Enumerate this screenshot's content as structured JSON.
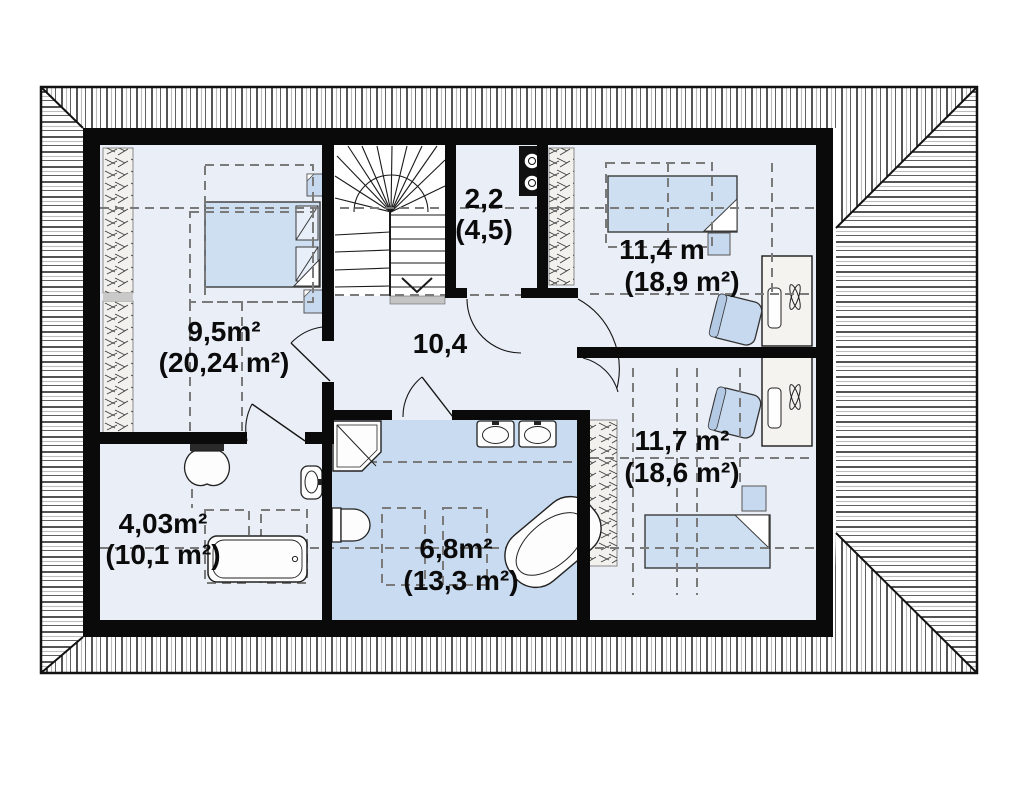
{
  "floorplan": {
    "type": "attic-floor-plan",
    "rooms": [
      {
        "id": "bedroom-1",
        "area": "9,5m²",
        "area_total": "(20,24 m²)"
      },
      {
        "id": "hall",
        "area": "10,4",
        "area_total": ""
      },
      {
        "id": "storage",
        "area": "2,2",
        "area_total": "(4,5)"
      },
      {
        "id": "bedroom-2",
        "area": "11,4 m",
        "area_total": "(18,9 m²)"
      },
      {
        "id": "bedroom-3",
        "area": "11,7 m²",
        "area_total": "(18,6 m²)"
      },
      {
        "id": "wc",
        "area": "4,03m²",
        "area_total": "(10,1 m²)"
      },
      {
        "id": "bathroom",
        "area": "6,8m²",
        "area_total": "(13,3 m²)"
      }
    ],
    "colors": {
      "walls": "#0a0a0a",
      "floor": "#eaeef7",
      "wet_room_floor": "#c9dbf0",
      "furniture_blue": "#c7d9ef",
      "bed_blue": "#cfdff2",
      "fixture_white": "#fdfdfd",
      "dash_gray": "#7a7a7a"
    }
  }
}
